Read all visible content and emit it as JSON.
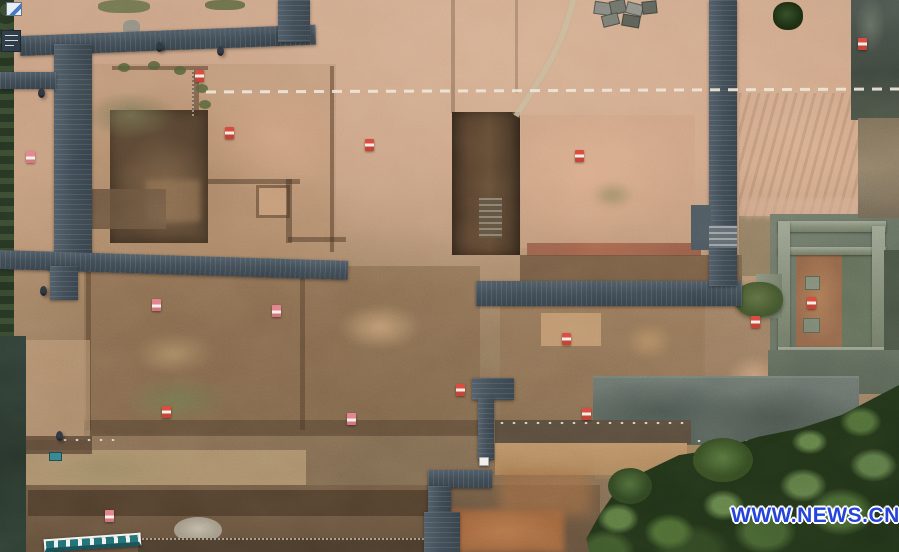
{
  "scene": {
    "kind": "aerial-drone-photograph",
    "aria_label": "Aerial view of an archaeological excavation site with dark boardwalks, earthen platforms, stone ruins and surrounding vegetation"
  },
  "watermark": {
    "text": "WWW.NEWS.CN",
    "color": "#2444da",
    "outline_color": "#ffffff"
  },
  "palette": {
    "dirt_light": "#cfa88a",
    "dirt_pink": "#d3a988",
    "dirt_mid": "#ae8a69",
    "dirt_dark": "#5f4a36",
    "boardwalk": "#3c4850",
    "stone_wall": "#79836f",
    "vegetation": "#24361d",
    "dash_line": "#ece4d4",
    "marker_red": "#d23b30",
    "marker_pink": "#e07b86"
  },
  "survey_line": {
    "style": "white-dashed",
    "x1": 206,
    "y1": 91,
    "x2": 899,
    "y2": 88
  },
  "markers": [
    {
      "x": 195,
      "y": 70,
      "variant": "red"
    },
    {
      "x": 225,
      "y": 127,
      "variant": "red"
    },
    {
      "x": 365,
      "y": 139,
      "variant": "red"
    },
    {
      "x": 575,
      "y": 150,
      "variant": "red"
    },
    {
      "x": 858,
      "y": 38,
      "variant": "red"
    },
    {
      "x": 26,
      "y": 151,
      "variant": "pink"
    },
    {
      "x": 152,
      "y": 299,
      "variant": "pink"
    },
    {
      "x": 272,
      "y": 305,
      "variant": "pink"
    },
    {
      "x": 562,
      "y": 333,
      "variant": "red"
    },
    {
      "x": 807,
      "y": 297,
      "variant": "red"
    },
    {
      "x": 751,
      "y": 316,
      "variant": "red"
    },
    {
      "x": 162,
      "y": 406,
      "variant": "red"
    },
    {
      "x": 456,
      "y": 384,
      "variant": "red"
    },
    {
      "x": 347,
      "y": 413,
      "variant": "pink"
    },
    {
      "x": 582,
      "y": 408,
      "variant": "red"
    },
    {
      "x": 479,
      "y": 457,
      "variant": "white"
    },
    {
      "x": 105,
      "y": 510,
      "variant": "pink"
    }
  ],
  "people": [
    {
      "x": 156,
      "y": 42
    },
    {
      "x": 217,
      "y": 46
    },
    {
      "x": 38,
      "y": 88
    },
    {
      "x": 40,
      "y": 286
    },
    {
      "x": 56,
      "y": 431
    }
  ],
  "moss_clumps": [
    {
      "x": 118,
      "y": 63
    },
    {
      "x": 148,
      "y": 61
    },
    {
      "x": 174,
      "y": 66
    },
    {
      "x": 196,
      "y": 84
    },
    {
      "x": 199,
      "y": 100
    }
  ]
}
